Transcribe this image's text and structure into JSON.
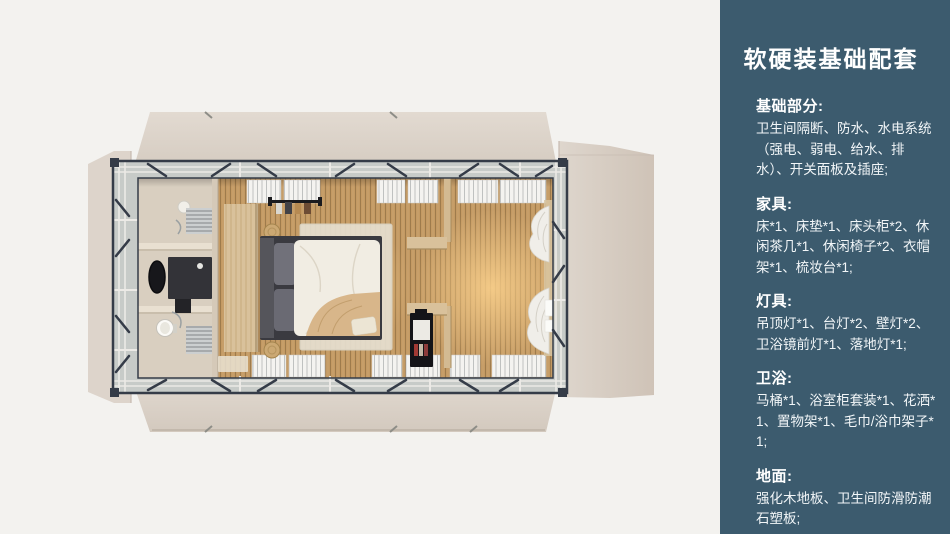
{
  "sidebar": {
    "title": "软硬装基础配套",
    "sections": [
      {
        "heading": "基础部分:",
        "body": "卫生间隔断、防水、水电系统（强电、弱电、给水、排水）、开关面板及插座;"
      },
      {
        "heading": "家具:",
        "body": "床*1、床垫*1、床头柜*2、休闲茶几*1、休闲椅子*2、衣帽架*1、梳妆台*1;"
      },
      {
        "heading": "灯具:",
        "body": "吊顶灯*1、台灯*2、壁灯*2、卫浴镜前灯*1、落地灯*1;"
      },
      {
        "heading": "卫浴:",
        "body": "马桶*1、浴室柜套装*1、花洒*1、置物架*1、毛巾/浴巾架子*1;"
      },
      {
        "heading": "地面:",
        "body": "强化木地板、卫生间防滑防潮石塑板;"
      }
    ]
  },
  "colors": {
    "sidebar_bg": "#3c5b6e",
    "sidebar_text": "#ffffff",
    "canvas_bg": "#f3f2ef",
    "wall": "#ddd4cb",
    "wall_edge": "#bfb3a7",
    "glass": "#c7cbc8",
    "steel": "#353c48",
    "rail": "#eceae6",
    "wood": "#c49a63",
    "wood_line": "#6f5530",
    "glow": "#ffd58f",
    "bath_floor": "#d9cfc0",
    "partition": "#e9e0d1",
    "panel_wood": "#d9c19b",
    "duvet": "#f1ede3",
    "throw": "#d8b68a",
    "dark": "#2b2b30",
    "blind": "#f4f3f0",
    "blind_line": "#bfc1c0",
    "curtain": "#f0eee9",
    "rug": "#e5decf"
  }
}
